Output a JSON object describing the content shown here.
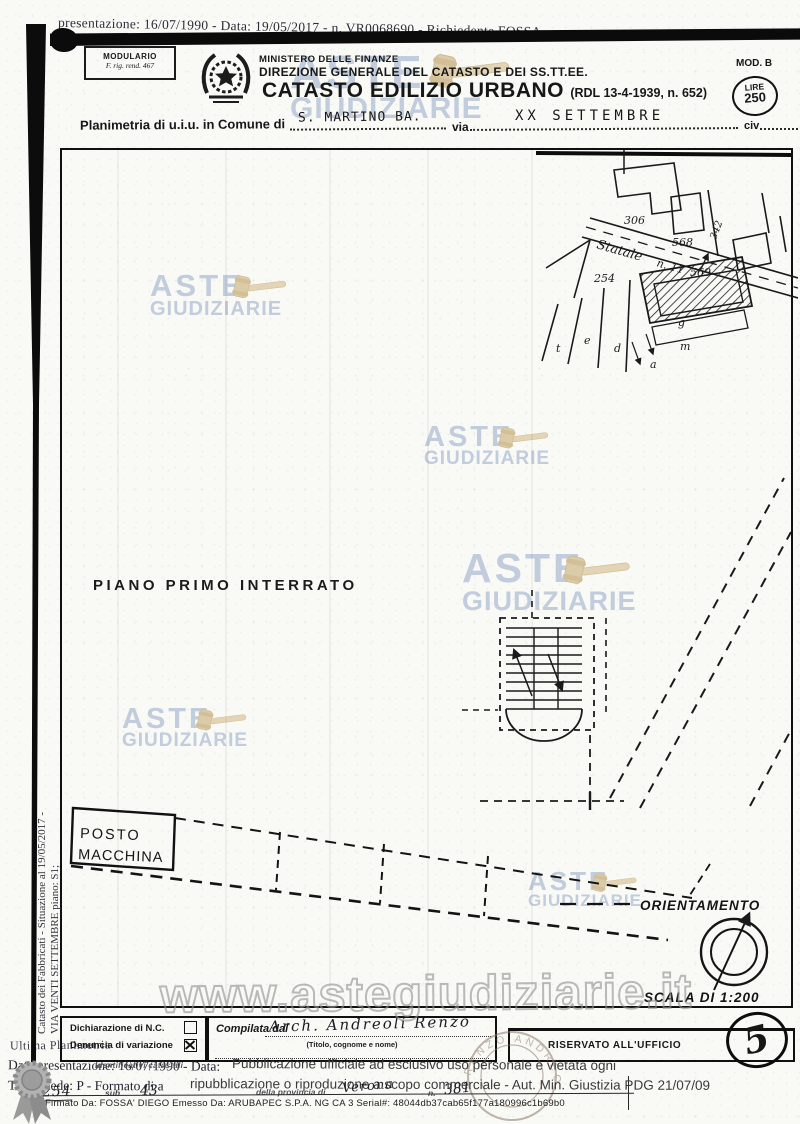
{
  "scan": {
    "top_strip": "presentazione: 16/07/1990 - Data: 19/05/2017 - n. VR0068690 - Richiedente FOSSA",
    "left_vertical_line1": "Catasto dei Fabbricati - Situazione al 19/05/2017 -",
    "left_vertical_line2": "VIA VENTI SETTEMBRE piano: S1;",
    "left_bottom_text": "Ultima Planimetria"
  },
  "header": {
    "modulario_line1": "MODULARIO",
    "modulario_line2": "F. rig. rend. 467",
    "ministry_line1": "MINISTERO DELLE FINANZE",
    "ministry_line2": "DIREZIONE GENERALE DEL CATASTO E DEI SS.TT.EE.",
    "title": "CATASTO EDILIZIO URBANO",
    "title_suffix": "(RDL 13-4-1939, n. 652)",
    "mod": "MOD. B",
    "lire_line1": "LIRE",
    "lire_line2": "250"
  },
  "plan_row": {
    "label": "Planimetria di u.i.u. in Comune di",
    "comune_value": "S. MARTINO BA.",
    "via_label": "via",
    "via_value": "XX SETTEMBRE",
    "civ_label": "civ"
  },
  "site_plan": {
    "road_name": "Statale",
    "road_number": "n. 11",
    "parcels": [
      "306",
      "568",
      "342",
      "569",
      "254"
    ],
    "letters": [
      "t",
      "e",
      "d",
      "g",
      "m",
      "a"
    ]
  },
  "plan": {
    "floor_label": "PIANO PRIMO INTERRATO",
    "parking_line1": "POSTO",
    "parking_line2": "MACCHINA",
    "orientation_label": "ORIENTAMENTO",
    "scale_label": "SCALA DI 1:200"
  },
  "watermark": {
    "line1": "ASTE",
    "line2": "GIUDIZIARIE",
    "url": "www.astegiudiziarie.it"
  },
  "bottom_form": {
    "declaration_label": "Dichiarazione di N.C.",
    "variation_label": "Denuncia di variazione",
    "compiled_label": "Compilata dal",
    "compiled_value": "Arch. Andreoli Renzo",
    "compiled_hint": "(Titolo, cognome e nome)",
    "office_label": "RISERVATO ALL'UFFICIO",
    "office_number": "5"
  },
  "stamp": {
    "text": "RENZO ANDREOLI"
  },
  "footer": {
    "date_line": "Data presentazione: 16/07/1990 - Data:",
    "identificativi": "Identificativi catastali",
    "overlay_line1": "Pubblicazione ufficiale ad esclusivo uso personale e vietata ogni",
    "tot_line": "Tot. schede: P - Formato di a",
    "overlay_line2": "ripubblicazione o riproduzione a scopo commerciale - Aut. Min. Giustizia PDG 21/07/09",
    "parcel_label": "n.",
    "parcel_value": "254",
    "sub_label": "sub",
    "sub_value": "43",
    "province_label": "della provincia di",
    "province_value": "Verona",
    "n_label": "n.",
    "n_value": "381",
    "signature": "Firmato Da: FOSSA' DIEGO Emesso Da: ARUBAPEC S.P.A. NG CA 3 Serial#: 48044db37cab65f177a180996c1b69b0"
  }
}
